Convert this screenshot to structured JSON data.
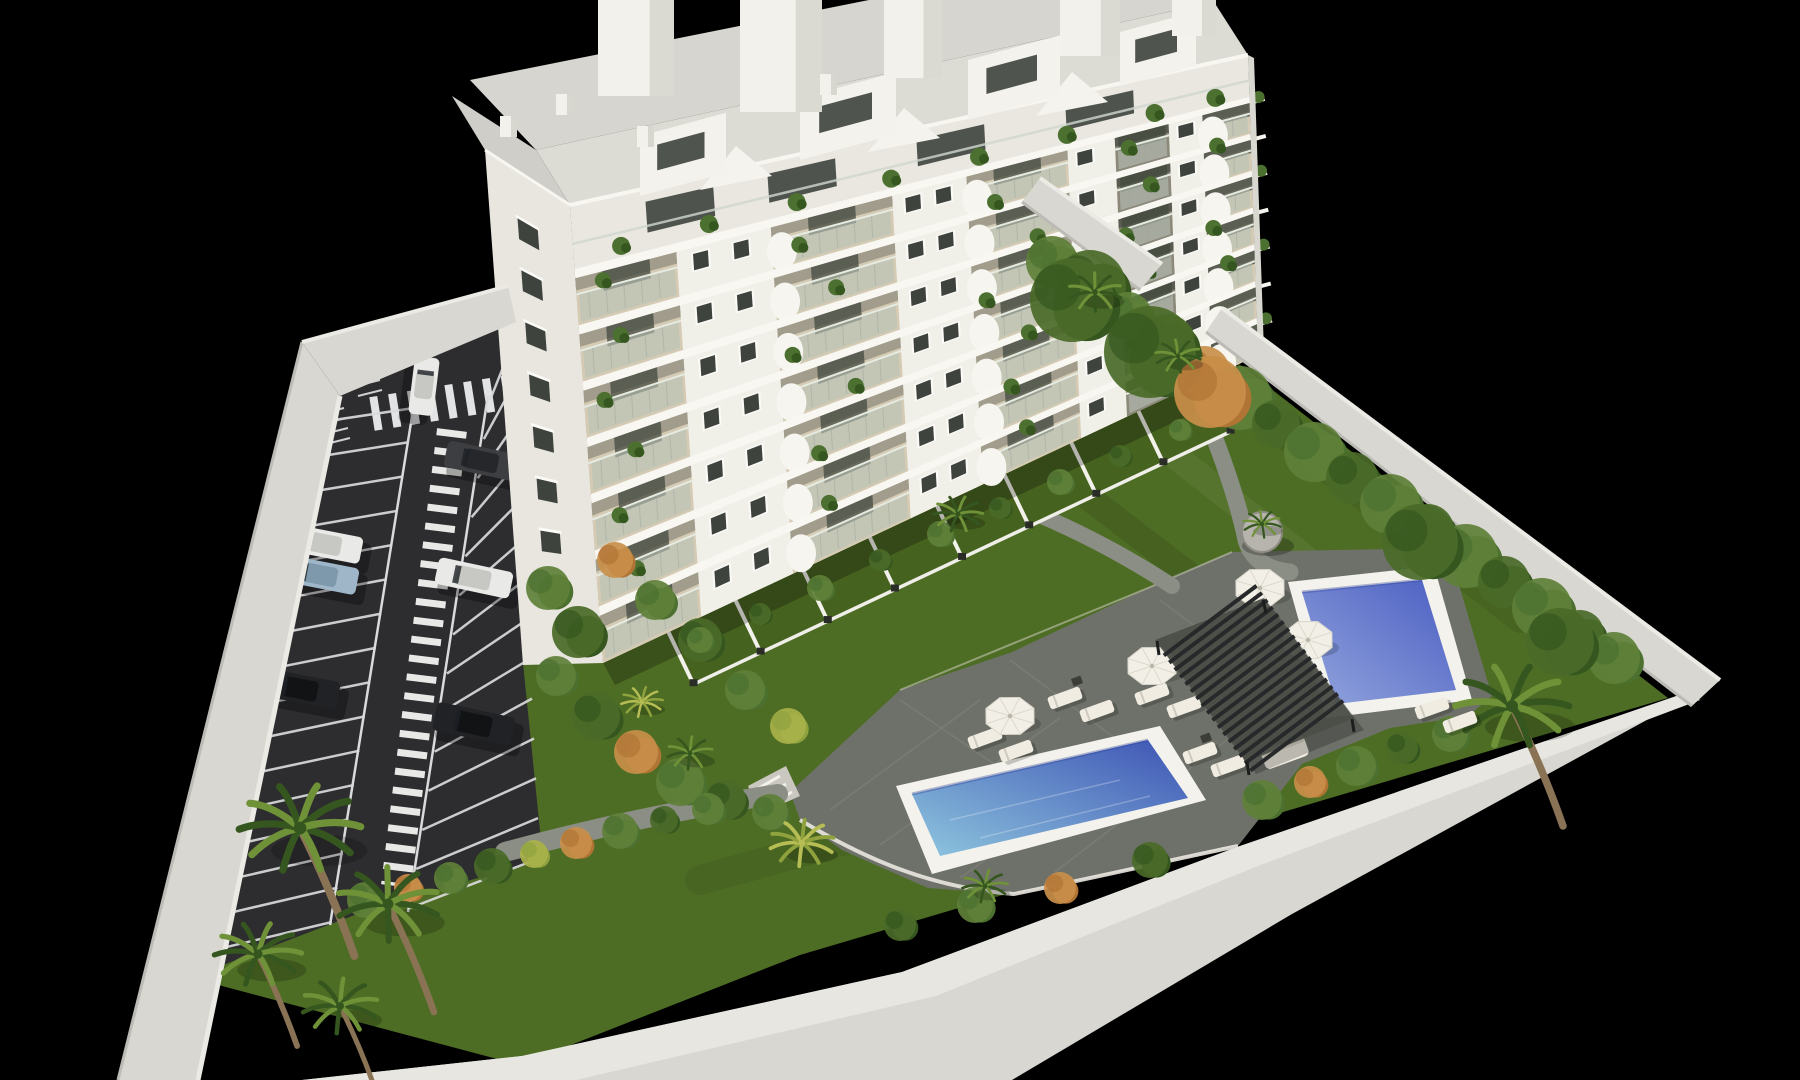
{
  "meta": {
    "description": "Aerial 3D architectural rendering of a white multi-storey apartment building with balconies, rooftop penthouses, a striped parking lot with cars, landscaped gardens, palm trees, a pergola lounge area and two blue swimming pools, enclosed by a white perimeter wall on a black background",
    "canvas": {
      "width": 1800,
      "height": 1080
    }
  },
  "palette": {
    "background": "#000000",
    "lawn": "#4e6d24",
    "lawn_bright": "#5a7c2b",
    "asphalt": "#2d2c2f",
    "road_marking": "#e2e3e4",
    "deck": "#6e7169",
    "deck_shadow": "#565950",
    "path": "#8b8e85",
    "pool_rim": "#f3f2ec",
    "pool1_shallow": "#8ec6de",
    "pool1_deep": "#3d53b4",
    "pool2_light": "#93a5dd",
    "pool2_deep": "#4a5ec2",
    "wall_top": "#e7e6e0",
    "wall_face": "#d8d7d1",
    "wall_shade": "#bcbbb5",
    "building_face": "#f0efe8",
    "building_side": "#e8e6de",
    "slab": "#f8f7f2",
    "balcony_floor": "#d5cbb4",
    "balcony_soffit": "#77766a",
    "recess_dark": "#57584e",
    "glass": "#b7c1b6",
    "window": "#3e433e",
    "roof_deck": "#d6d5cf",
    "pergola": "#26282a",
    "furniture": "#f0ece1",
    "plant": "#4c7030",
    "plant_dark": "#35571f",
    "plant_yellow": "#8fa23e",
    "orange_shrub": "#b07434",
    "trunk": "#8a7355",
    "car_white": "#e9e9e7",
    "car_black": "#212225",
    "car_gray": "#3d3e42",
    "car_blue": "#9fb6c8"
  },
  "building": {
    "front_corners": {
      "tl": [
        570,
        205
      ],
      "tr": [
        1248,
        55
      ],
      "br": [
        1258,
        355
      ],
      "bl": [
        603,
        663
      ]
    },
    "side_corners": {
      "tl": [
        485,
        150
      ],
      "tr": [
        570,
        205
      ],
      "br": [
        603,
        663
      ],
      "bl": [
        523,
        665
      ]
    },
    "floors": 7,
    "penthouse_fraction": 0.14,
    "bays": [
      {
        "type": "balcony",
        "u0": 0.0,
        "u1": 0.15
      },
      {
        "type": "pier",
        "u0": 0.15,
        "u1": 0.29,
        "windows": [
          0.185,
          0.245
        ]
      },
      {
        "type": "balcony",
        "u0": 0.29,
        "u1": 0.47
      },
      {
        "type": "pier",
        "u0": 0.47,
        "u1": 0.58,
        "windows": [
          0.5,
          0.545
        ]
      },
      {
        "type": "balcony",
        "u0": 0.58,
        "u1": 0.73
      },
      {
        "type": "pier",
        "u0": 0.73,
        "u1": 0.8,
        "windows": [
          0.755
        ]
      },
      {
        "type": "balcony-deep",
        "u0": 0.8,
        "u1": 0.88
      },
      {
        "type": "pier",
        "u0": 0.88,
        "u1": 0.93,
        "windows": [
          0.905
        ]
      },
      {
        "type": "balcony",
        "u0": 0.93,
        "u1": 1.0
      }
    ],
    "curved_fronts": [
      0.305,
      0.595,
      0.945
    ],
    "balcony_plants": [
      [
        0.04,
        0.18
      ],
      [
        0.06,
        0.31
      ],
      [
        0.03,
        0.44
      ],
      [
        0.07,
        0.57
      ],
      [
        0.04,
        0.7
      ],
      [
        0.06,
        0.83
      ],
      [
        0.33,
        0.22
      ],
      [
        0.38,
        0.35
      ],
      [
        0.31,
        0.48
      ],
      [
        0.4,
        0.61
      ],
      [
        0.34,
        0.74
      ],
      [
        0.62,
        0.25
      ],
      [
        0.68,
        0.38
      ],
      [
        0.6,
        0.51
      ],
      [
        0.66,
        0.64
      ],
      [
        0.63,
        0.77
      ],
      [
        0.82,
        0.2
      ],
      [
        0.85,
        0.33
      ],
      [
        0.81,
        0.46
      ],
      [
        0.84,
        0.59
      ],
      [
        0.82,
        0.72
      ],
      [
        0.95,
        0.27
      ],
      [
        0.94,
        0.53
      ],
      [
        0.96,
        0.66
      ],
      [
        0.35,
        0.87
      ],
      [
        0.65,
        0.9
      ]
    ],
    "penthouse_windows": [
      0.16,
      0.34,
      0.56,
      0.78
    ],
    "penthouse_plants": [
      0.07,
      0.2,
      0.33,
      0.47,
      0.6,
      0.73,
      0.86,
      0.95
    ],
    "side_window_rows": 8,
    "volumes": [
      [
        640,
        196,
        86,
        60
      ],
      [
        800,
        160,
        96,
        62
      ],
      [
        968,
        120,
        92,
        60
      ],
      [
        1120,
        86,
        76,
        54
      ]
    ],
    "gables": [
      [
        700,
        190
      ],
      [
        868,
        152
      ],
      [
        1036,
        116
      ]
    ],
    "bulkheads": [
      [
        598,
        0,
        76,
        96
      ],
      [
        740,
        0,
        82,
        112
      ],
      [
        884,
        0,
        58,
        78
      ],
      [
        1060,
        0,
        60,
        56
      ],
      [
        1172,
        0,
        44,
        36
      ]
    ],
    "chimneys": [
      [
        500,
        116
      ],
      [
        556,
        94
      ],
      [
        637,
        126
      ],
      [
        820,
        74
      ]
    ]
  },
  "parking": {
    "left_stalls": 16,
    "right_stalls": 14,
    "cars": [
      {
        "x": 424,
        "y": 386,
        "rot": 97,
        "len": 58,
        "wid": 25,
        "color": "car_white"
      },
      {
        "x": 482,
        "y": 461,
        "rot": 12,
        "len": 74,
        "wid": 27,
        "color": "car_gray"
      },
      {
        "x": 325,
        "y": 544,
        "rot": 11,
        "len": 74,
        "wid": 27,
        "color": "car_white"
      },
      {
        "x": 321,
        "y": 575,
        "rot": 11,
        "len": 74,
        "wid": 27,
        "color": "car_blue"
      },
      {
        "x": 474,
        "y": 578,
        "rot": 12,
        "len": 76,
        "wid": 27,
        "color": "car_white"
      },
      {
        "x": 301,
        "y": 689,
        "rot": 11,
        "len": 76,
        "wid": 28,
        "color": "car_black"
      },
      {
        "x": 474,
        "y": 724,
        "rot": 12,
        "len": 80,
        "wid": 29,
        "color": "car_black"
      },
      {
        "x": 1158,
        "y": 287,
        "rot": 99,
        "len": 56,
        "wid": 24,
        "color": "car_white"
      }
    ]
  },
  "amenities": {
    "umbrellas": [
      [
        1010,
        716
      ],
      [
        1152,
        666
      ],
      [
        1260,
        588
      ],
      [
        1308,
        640
      ]
    ],
    "loungers": [
      [
        1065,
        698
      ],
      [
        1097,
        711
      ],
      [
        985,
        738
      ],
      [
        1016,
        751
      ],
      [
        1152,
        694
      ],
      [
        1184,
        707
      ],
      [
        1200,
        753
      ],
      [
        1228,
        766
      ],
      [
        1432,
        708
      ],
      [
        1460,
        722
      ]
    ],
    "sofa": [
      1285,
      753
    ],
    "tables": [
      [
        1077,
        681
      ],
      [
        998,
        724
      ],
      [
        1206,
        738
      ]
    ]
  },
  "vegetation": {
    "palms": [
      [
        300,
        828,
        1.6,
        0
      ],
      [
        388,
        904,
        1.35,
        0
      ],
      [
        258,
        954,
        1.15,
        0
      ],
      [
        340,
        1006,
        1.0,
        0
      ],
      [
        802,
        843,
        0.85,
        1
      ],
      [
        985,
        886,
        0.6,
        0
      ],
      [
        958,
        514,
        0.65,
        0
      ],
      [
        1512,
        706,
        1.5,
        0
      ],
      [
        690,
        753,
        0.6,
        0
      ],
      [
        642,
        702,
        0.55,
        1
      ],
      [
        1095,
        292,
        0.7,
        0
      ],
      [
        1178,
        356,
        0.6,
        0
      ],
      [
        1262,
        524,
        0.5,
        0
      ]
    ],
    "hedge_right": [
      [
        1052,
        262,
        26,
        1
      ],
      [
        1090,
        286,
        36,
        0
      ],
      [
        1128,
        316,
        24,
        1
      ],
      [
        1166,
        344,
        30,
        0
      ],
      [
        1204,
        372,
        26,
        2
      ],
      [
        1240,
        398,
        32,
        1
      ],
      [
        1276,
        424,
        24,
        0
      ],
      [
        1314,
        452,
        30,
        1
      ],
      [
        1352,
        478,
        26,
        0
      ],
      [
        1390,
        504,
        30,
        1
      ],
      [
        1428,
        530,
        26,
        0
      ],
      [
        1466,
        556,
        32,
        1
      ],
      [
        1504,
        582,
        26,
        0
      ],
      [
        1542,
        608,
        30,
        1
      ],
      [
        1580,
        634,
        24,
        0
      ],
      [
        1614,
        658,
        26,
        1
      ],
      [
        1072,
        300,
        42,
        0
      ],
      [
        1150,
        352,
        46,
        0
      ],
      [
        1210,
        392,
        36,
        2
      ],
      [
        1420,
        542,
        38,
        0
      ],
      [
        1560,
        642,
        34,
        0
      ]
    ],
    "garden_strip": [
      [
        548,
        588,
        22,
        1
      ],
      [
        578,
        632,
        26,
        0
      ],
      [
        556,
        676,
        20,
        1
      ],
      [
        596,
        716,
        24,
        0
      ],
      [
        636,
        752,
        22,
        2
      ],
      [
        680,
        782,
        24,
        1
      ],
      [
        726,
        800,
        20,
        0
      ],
      [
        770,
        812,
        18,
        1
      ],
      [
        615,
        560,
        18,
        2
      ],
      [
        655,
        600,
        20,
        1
      ],
      [
        700,
        640,
        22,
        0
      ],
      [
        745,
        690,
        20,
        1
      ],
      [
        788,
        726,
        18,
        3
      ]
    ],
    "parking_row": [
      [
        365,
        900,
        18,
        1
      ],
      [
        408,
        888,
        14,
        2
      ],
      [
        450,
        878,
        16,
        1
      ],
      [
        492,
        866,
        18,
        0
      ],
      [
        534,
        854,
        14,
        3
      ],
      [
        576,
        843,
        16,
        2
      ],
      [
        620,
        831,
        18,
        1
      ],
      [
        664,
        820,
        14,
        0
      ],
      [
        708,
        809,
        16,
        1
      ]
    ],
    "wall_row": [
      [
        1262,
        800,
        20,
        1
      ],
      [
        1310,
        782,
        16,
        2
      ],
      [
        1356,
        766,
        20,
        1
      ],
      [
        1402,
        748,
        16,
        0
      ],
      [
        1450,
        734,
        18,
        1
      ],
      [
        1150,
        860,
        18,
        0
      ],
      [
        1060,
        888,
        16,
        2
      ],
      [
        975,
        905,
        18,
        1
      ],
      [
        900,
        925,
        16,
        0
      ]
    ],
    "terrace_hedge": [
      [
        700,
        640,
        13,
        1
      ],
      [
        760,
        614,
        11,
        0
      ],
      [
        820,
        588,
        13,
        1
      ],
      [
        880,
        560,
        11,
        0
      ],
      [
        940,
        534,
        13,
        1
      ],
      [
        1000,
        508,
        11,
        0
      ],
      [
        1060,
        482,
        13,
        1
      ],
      [
        1120,
        456,
        11,
        0
      ],
      [
        1180,
        430,
        11,
        1
      ]
    ],
    "planter": {
      "x": 1262,
      "y": 532,
      "r": 20
    }
  }
}
